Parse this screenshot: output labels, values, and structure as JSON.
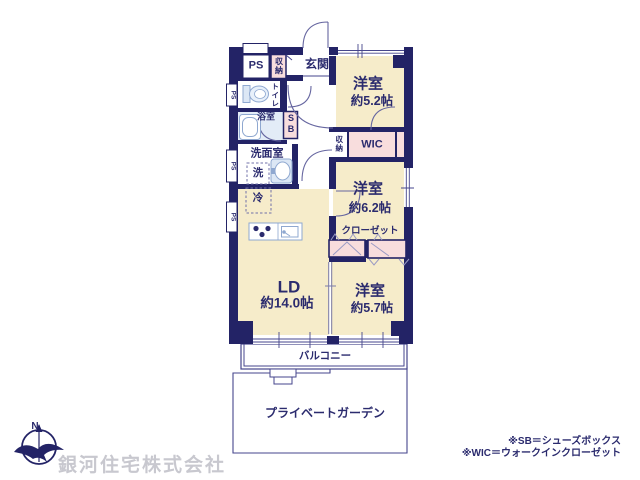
{
  "plan": {
    "ps_meter": "PS",
    "entry_storage": "収納",
    "genkan": "玄関",
    "bedroom1_name": "洋室",
    "bedroom1_size": "約5.2帖",
    "toilet": "トイレ",
    "bath": "浴室",
    "shoe_box": "SB",
    "washroom": "洗面室",
    "washer": "洗",
    "side_ps": "PS",
    "hall_storage": "収納",
    "wic": "WIC",
    "bedroom2_name": "洋室",
    "bedroom2_size": "約6.2帖",
    "closet": "クローゼット",
    "fridge": "冷",
    "ld_name": "LD",
    "ld_size": "約14.0帖",
    "bedroom3_name": "洋室",
    "bedroom3_size": "約5.7帖",
    "balcony": "バルコニー",
    "garden": "プライベートガーデン",
    "compass_n": "N"
  },
  "footer": {
    "company": "銀河住宅株式会社",
    "note_sb": "※SB＝シューズボックス",
    "note_wic": "※WIC＝ウォークインクローゼット"
  },
  "colors": {
    "wall_navy": "#232366",
    "room_cream": "#F6ECCA",
    "closet_pink": "#F8DDDD",
    "bath_blue": "#E3ECF7",
    "line_navy": "#46468C",
    "icon_blue": "#8FA8D0",
    "text_navy": "#2B2B6E",
    "watermark_gray": "#C8C8CF"
  }
}
